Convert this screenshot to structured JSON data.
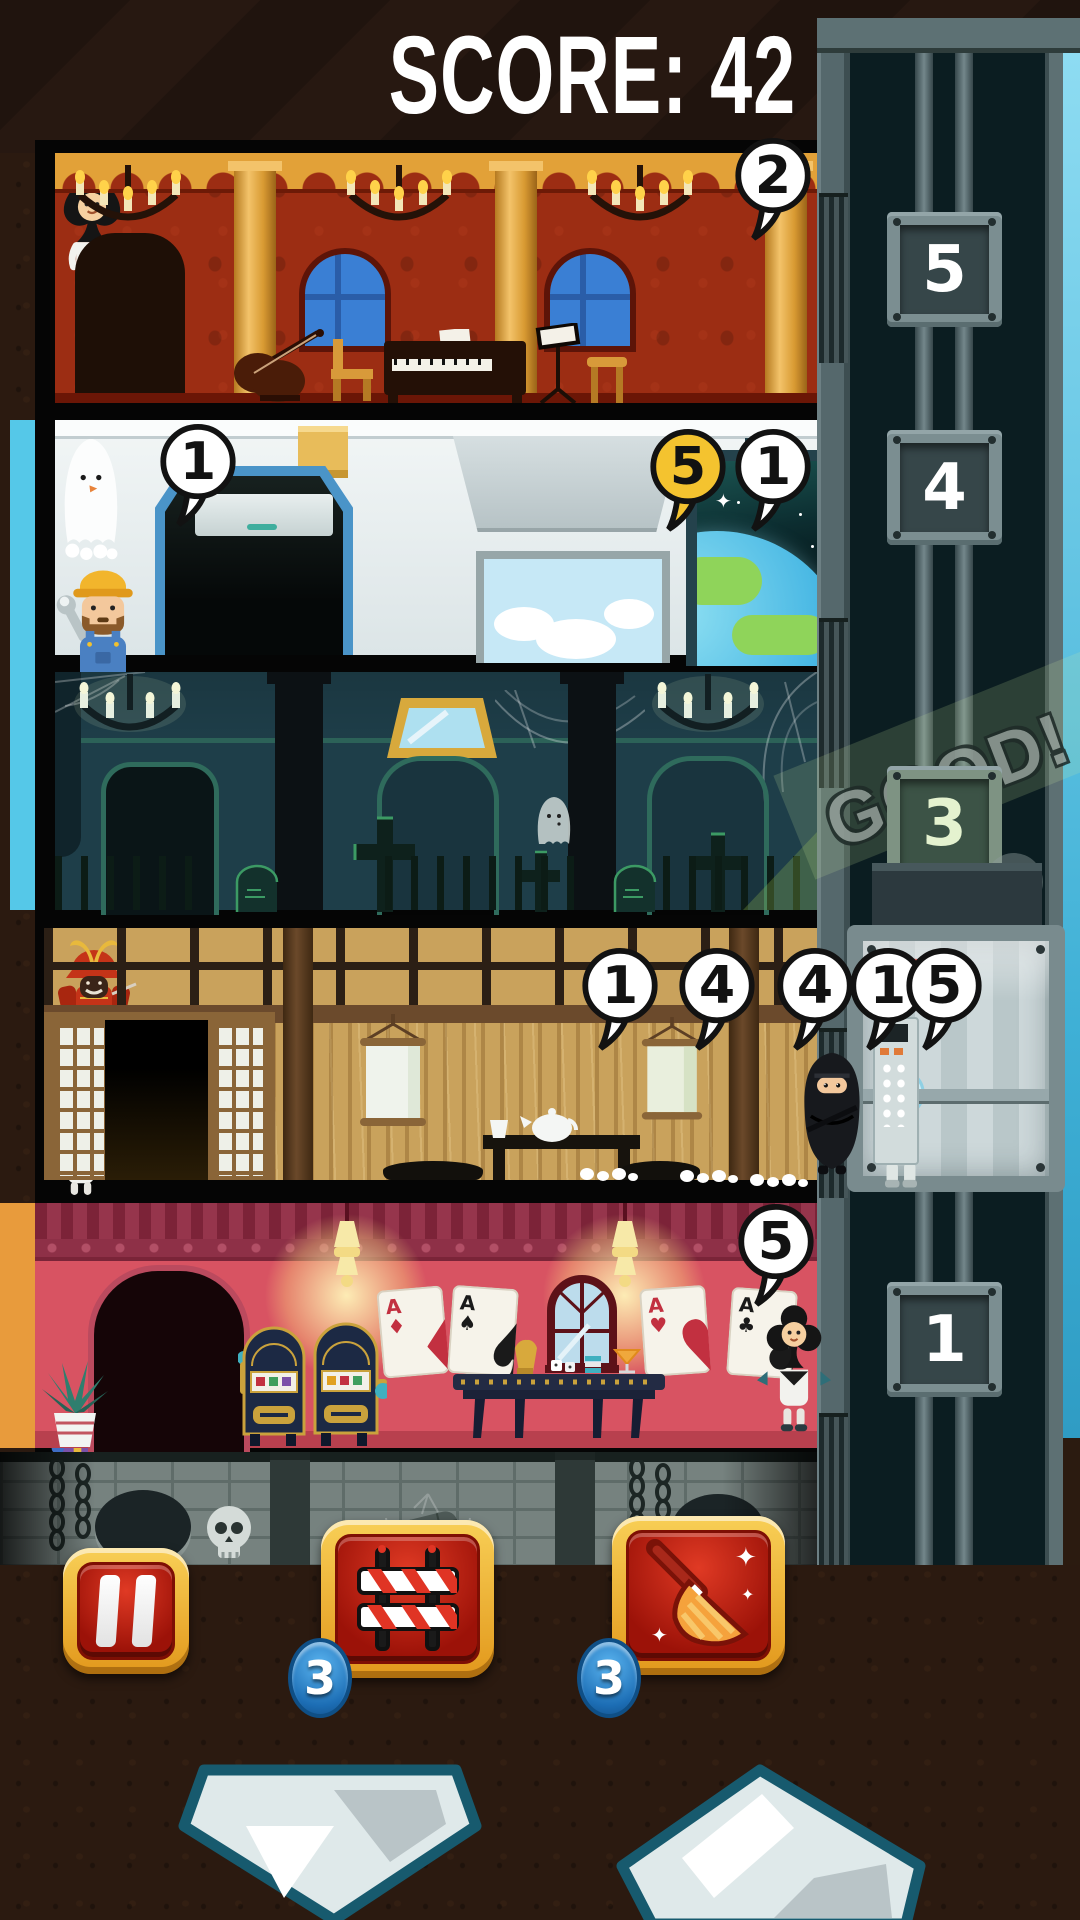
{
  "header": {
    "score_label": "SCORE:",
    "score_value": "42"
  },
  "shaft": {
    "feedback": "GOOD!",
    "plates": [
      {
        "floor": "5"
      },
      {
        "floor": "4"
      },
      {
        "floor": "3"
      },
      {
        "floor": "1"
      }
    ]
  },
  "elevator": {
    "passengers": [
      {
        "type": "heart-costume",
        "bubble": "1"
      },
      {
        "type": "astronaut",
        "bubble": "5"
      }
    ]
  },
  "floors": [
    {
      "id": "music-room",
      "characters": [
        {
          "type": "spade-costume",
          "bubble": "2"
        }
      ]
    },
    {
      "id": "spaceship",
      "characters": [
        {
          "type": "ghost",
          "bubble": "1"
        },
        {
          "type": "builder",
          "bubble": "5",
          "bubble_color": "#f4c32f"
        },
        {
          "type": "astronaut",
          "bubble": "1"
        }
      ]
    },
    {
      "id": "haunted-hall",
      "characters": [
        {
          "type": "mini-ghost"
        }
      ]
    },
    {
      "id": "tatami-room",
      "characters": [
        {
          "type": "samurai-armor"
        },
        {
          "type": "heart-costume",
          "bubble": "1"
        },
        {
          "type": "frankenstein",
          "bubble": "4"
        },
        {
          "type": "kabuki",
          "bubble": "4"
        },
        {
          "type": "ninja"
        }
      ]
    },
    {
      "id": "casino",
      "cards": [
        {
          "rank": "A",
          "suit": "♦"
        },
        {
          "rank": "A",
          "suit": "♠"
        },
        {
          "rank": "A",
          "suit": "♥"
        },
        {
          "rank": "A",
          "suit": "♣"
        }
      ],
      "characters": [
        {
          "type": "club-costume",
          "bubble": "5"
        }
      ]
    }
  ],
  "hud": {
    "pause": {
      "icon": "pause-icon"
    },
    "barrier": {
      "icon": "barrier-icon",
      "count": "3"
    },
    "broom": {
      "icon": "broom-icon",
      "count": "3"
    },
    "down": {
      "icon": "elevator-down-icon"
    },
    "up": {
      "icon": "elevator-up-icon"
    }
  },
  "colors": {
    "bubble_gold": "#f4c32f",
    "badge_blue": "#2e8fd4",
    "button_gold": "#f0b42a",
    "button_red": "#c8231a",
    "good_text": "#8f9b95",
    "sky": "#55c8e8"
  }
}
